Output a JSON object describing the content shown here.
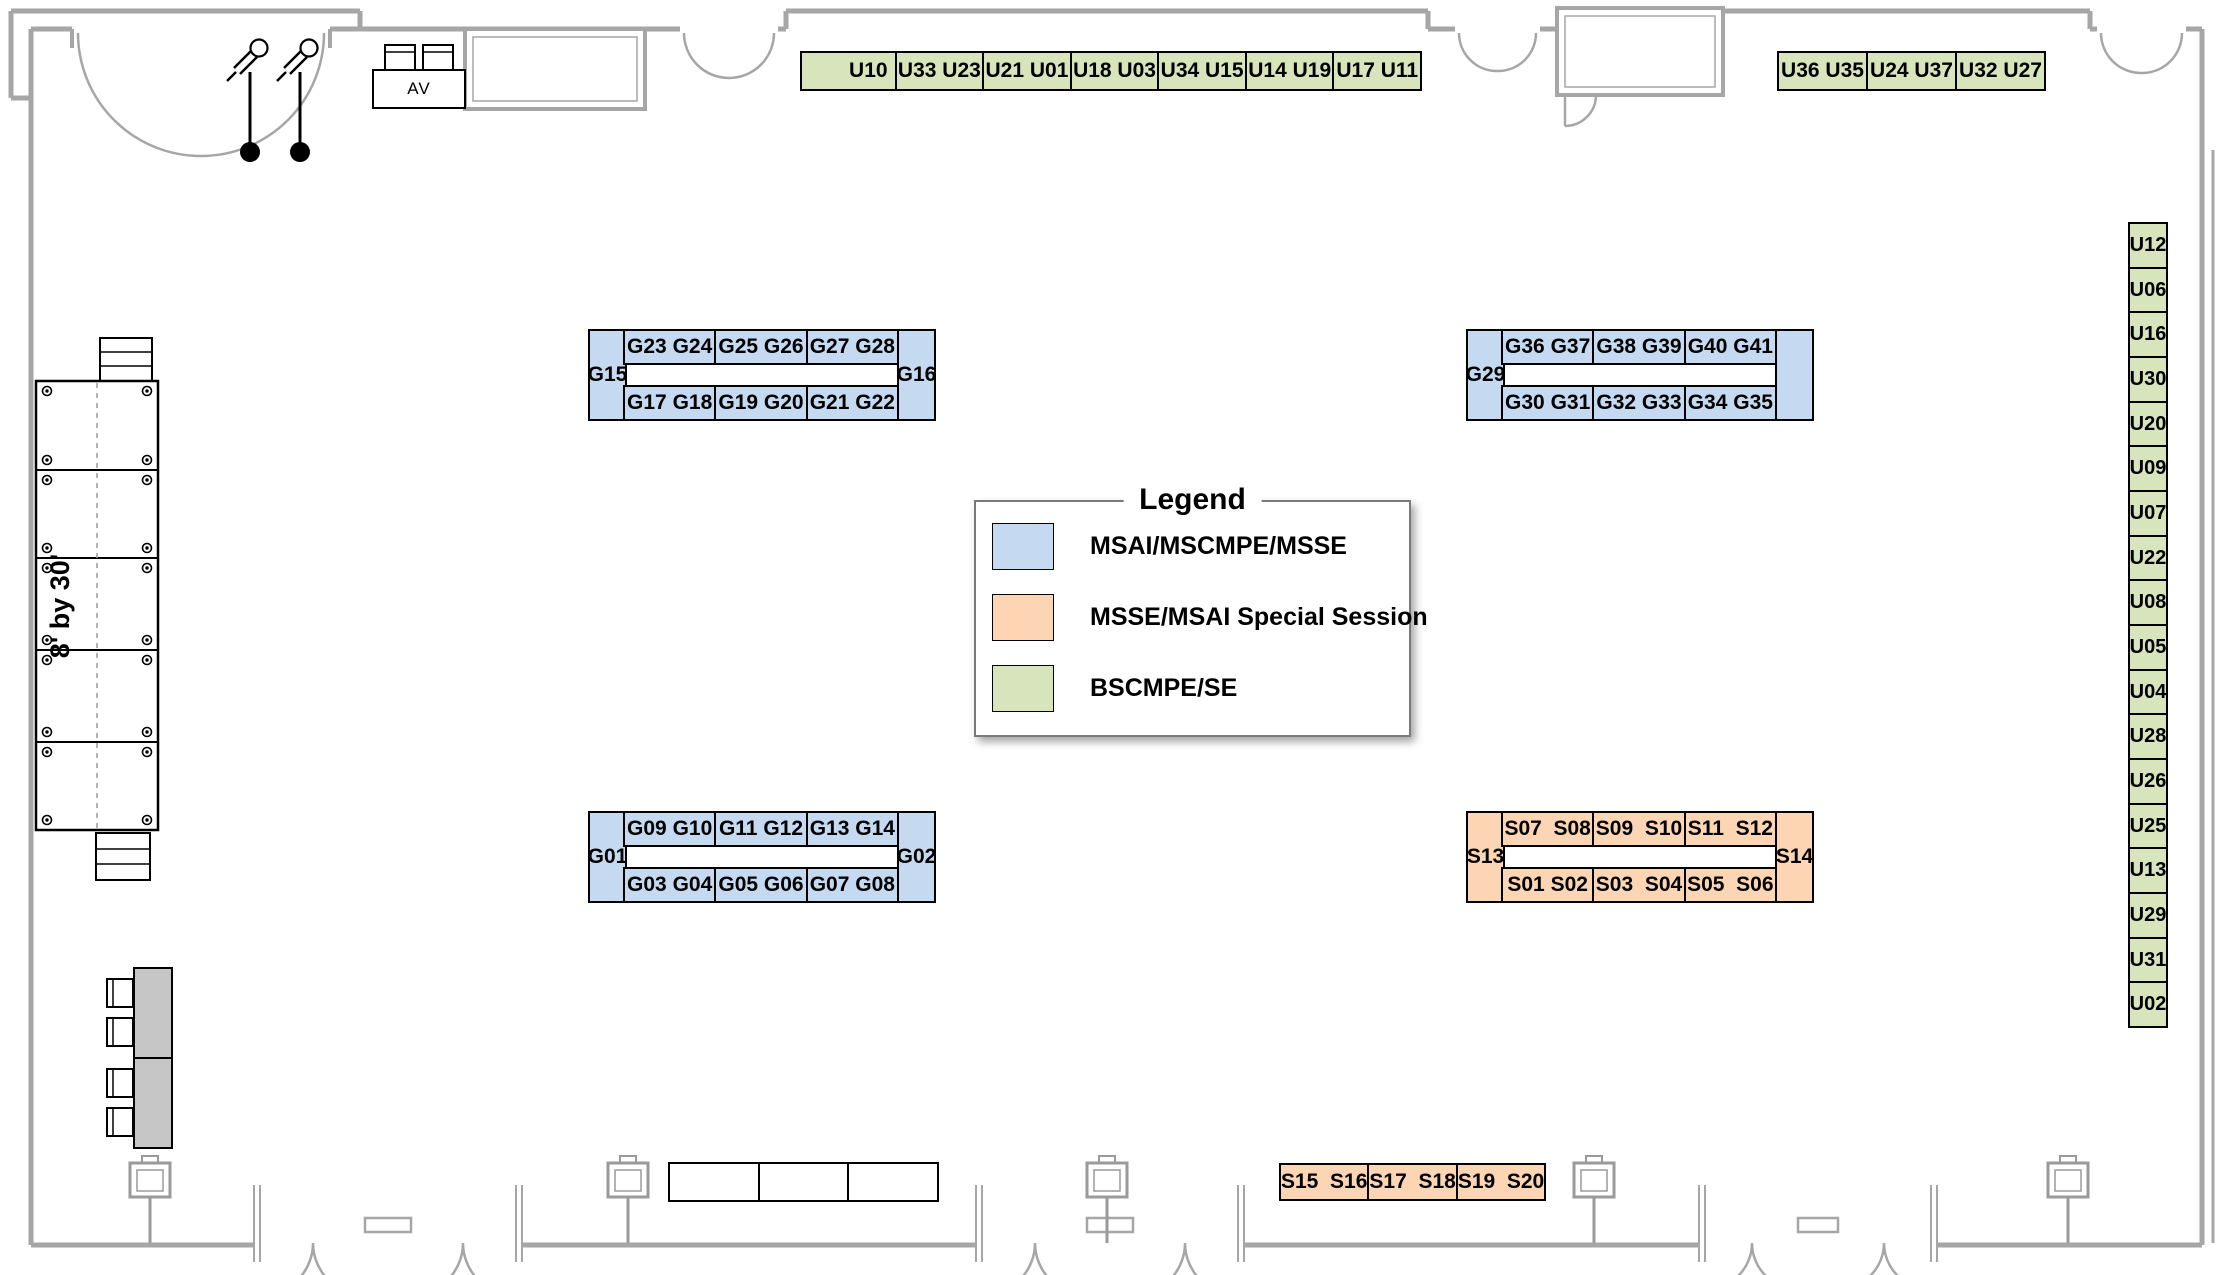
{
  "legend": {
    "title": "Legend",
    "items": [
      {
        "label": "MSAI/MSCMPE/MSSE",
        "color": "#c5d9f1"
      },
      {
        "label": "MSSE/MSAI Special Session",
        "color": "#fbd5b4"
      },
      {
        "label": "BSCMPE/SE",
        "color": "#d7e4bc"
      }
    ]
  },
  "annotations": {
    "av": "AV",
    "stage_size": "8' by 30'"
  },
  "colors": {
    "blue_booth": "#c5d9f1",
    "orange_booth": "#fbd5b4",
    "green_booth": "#d7e4bc",
    "wall_gray": "#a6a6a6",
    "table_gray": "#c6c6c6"
  },
  "booths": {
    "top_wall_green": {
      "cells": [
        "U10",
        "U33 U23",
        "U21 U01",
        "U18 U03",
        "U34 U15",
        "U14 U19",
        "U17 U11"
      ]
    },
    "top_right_green": {
      "cells": [
        "U36 U35",
        "U24 U37",
        "U32 U27"
      ]
    },
    "right_wall_green": {
      "cells": [
        "U12",
        "U06",
        "U16",
        "U30",
        "U20",
        "U09",
        "U07",
        "U22",
        "U08",
        "U05",
        "U04",
        "U28",
        "U26",
        "U25",
        "U13",
        "U29",
        "U31",
        "U02"
      ]
    },
    "g_north": {
      "left": "G15",
      "right": "G16",
      "top": [
        "G23 G24",
        "G25 G26",
        "G27 G28"
      ],
      "bottom": [
        "G17 G18",
        "G19 G20",
        "G21 G22"
      ]
    },
    "g_east": {
      "left": "G29",
      "right": "",
      "top": [
        "G36 G37",
        "G38 G39",
        "G40 G41"
      ],
      "bottom": [
        "G30 G31",
        "G32 G33",
        "G34 G35"
      ]
    },
    "g_south": {
      "left": "G01",
      "right": "G02",
      "top": [
        "G09 G10",
        "G11 G12",
        "G13 G14"
      ],
      "bottom": [
        "G03 G04",
        "G05 G06",
        "G07 G08"
      ]
    },
    "s_island": {
      "left": "S13",
      "right": "S14",
      "top": [
        "S07  S08",
        "S09  S10",
        "S11  S12"
      ],
      "bottom": [
        "S01 S02",
        "S03  S04",
        "S05  S06"
      ]
    },
    "bottom_wall_orange": {
      "cells": [
        "S15  S16",
        "S17  S18",
        "S19  S20"
      ]
    }
  }
}
